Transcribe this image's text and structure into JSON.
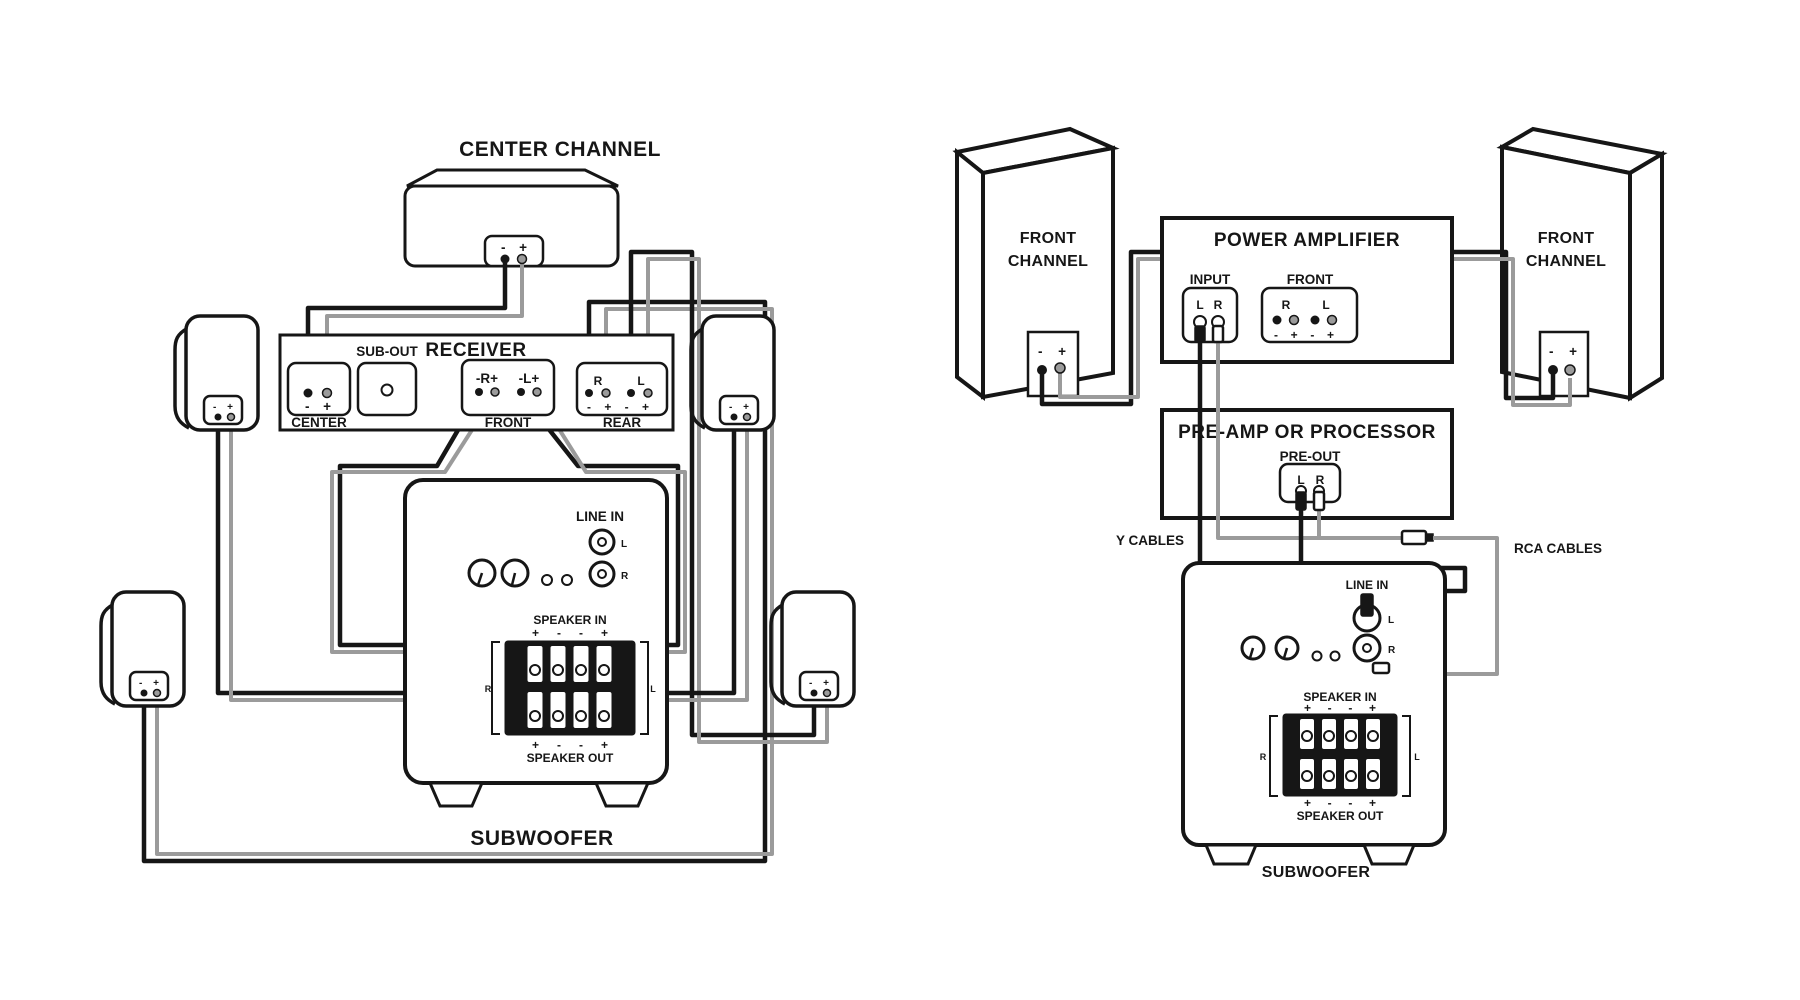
{
  "sym": {
    "minus": "-",
    "plus": "+",
    "L": "L",
    "R": "R"
  },
  "pol": {
    "cup": "- +",
    "io_in": "+ - - +",
    "io_out": "+ - - +",
    "rear": "- + - +",
    "amp_front": "- + - +"
  },
  "left": {
    "center_channel": "CENTER CHANNEL",
    "receiver": "RECEIVER",
    "sub_out": "SUB-OUT",
    "center": "CENTER",
    "front": "FRONT",
    "rear": "REAR",
    "front_r": "-R+",
    "front_l": "-L+",
    "line_in": "LINE IN",
    "speaker_in": "SPEAKER IN",
    "speaker_out": "SPEAKER OUT",
    "subwoofer": "SUBWOOFER"
  },
  "right": {
    "front_channel_line1": "FRONT",
    "front_channel_line2": "CHANNEL",
    "power_amplifier": "POWER AMPLIFIER",
    "input": "INPUT",
    "front": "FRONT",
    "preamp": "PRE-AMP OR PROCESSOR",
    "pre_out": "PRE-OUT",
    "y_cables": "Y CABLES",
    "rca_cables": "RCA CABLES",
    "line_in": "LINE IN",
    "speaker_in": "SPEAKER IN",
    "speaker_out": "SPEAKER OUT",
    "subwoofer": "SUBWOOFER"
  }
}
